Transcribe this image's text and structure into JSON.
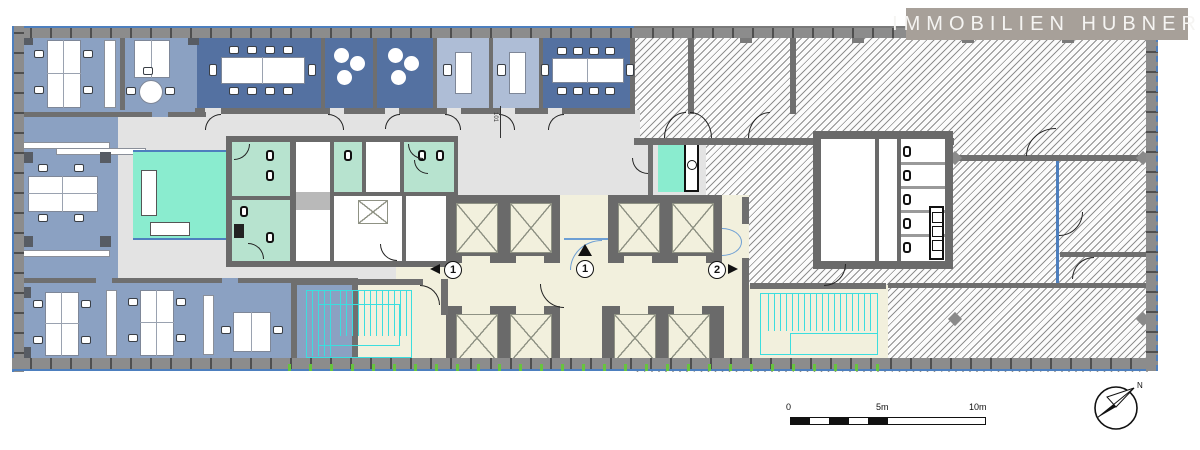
{
  "brand": {
    "logo_text": "IMMOBILIEN HUBNER"
  },
  "markers": {
    "left": "1",
    "center": "1",
    "right": "2"
  },
  "scale_bar": {
    "start": "0",
    "mid": "5m",
    "end": "10m"
  },
  "compass": {
    "label": "N"
  },
  "annotations": {
    "dim_label": "101"
  },
  "palette": {
    "facade_blue": "#4d7fbe",
    "open_office_blue": "#8ba1c2",
    "meeting_room_blue": "#5471a1",
    "single_office_blue": "#aebdd6",
    "wet_room_mint": "#b7e3cf",
    "lounge_mint": "#8aeccf",
    "circulation_cream": "#f2f0dd",
    "common_grey": "#e3e3e3",
    "stair_cyan": "#3cdede",
    "tick_green": "#67c43e",
    "logo_bg": "#a7a099"
  }
}
